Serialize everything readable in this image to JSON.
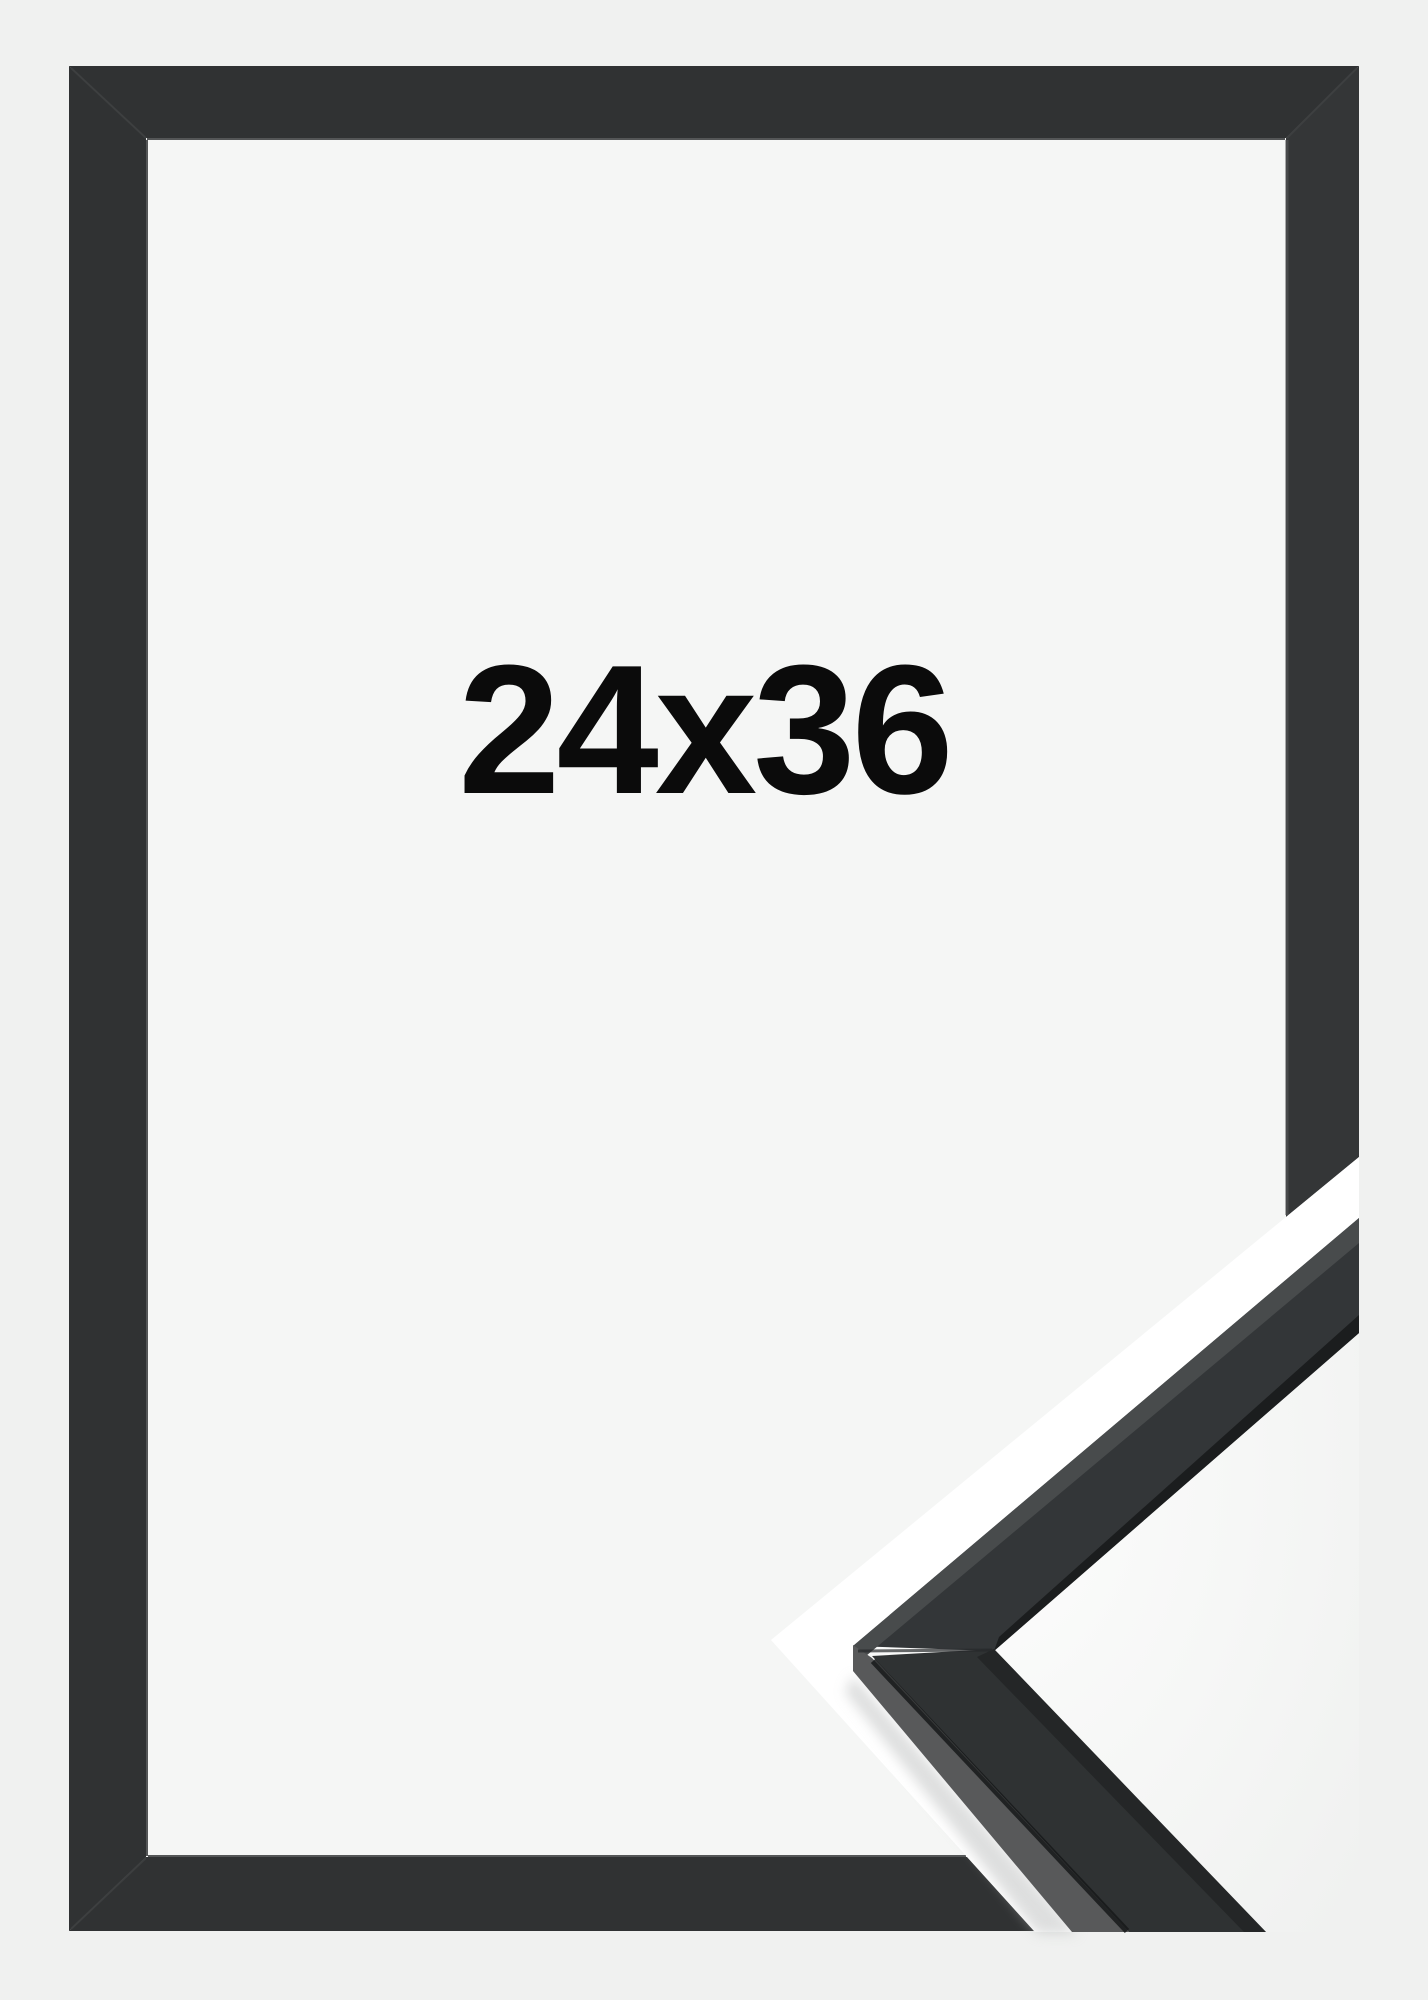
{
  "product_photo": {
    "size_label": "24x36"
  },
  "colors": {
    "page_bg": "#f0f1f0",
    "opening_bg": "#f5f6f5",
    "frame_black": "#303233",
    "frame_black_right": "#343637",
    "detail_front": "#333638",
    "detail_front_lower": "#2f3233",
    "detail_side": "#58595a",
    "detail_top_edge": "#484b4c",
    "detail_lip": "#1b1d1e",
    "margin_white": "#ffffff",
    "label_color": "#0b0b0b"
  }
}
